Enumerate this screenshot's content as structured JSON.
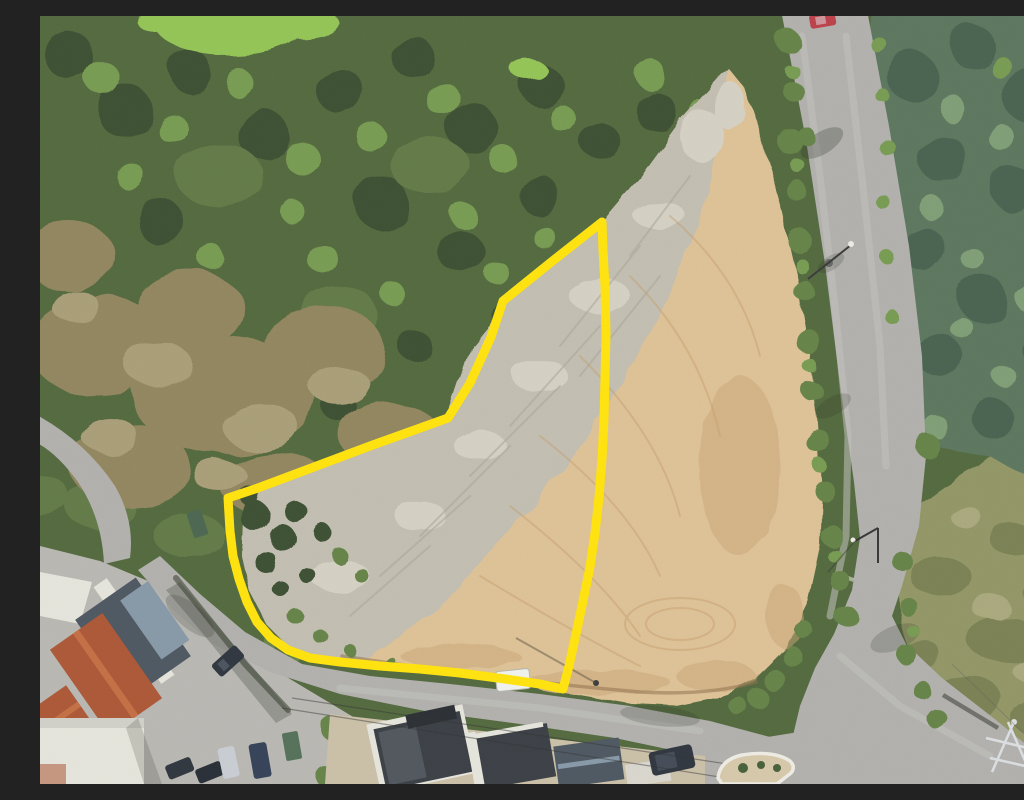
{
  "image": {
    "kind": "aerial-drone-photo",
    "subject": "Cleared building plot outlined in yellow between woodland and a rural road junction with houses at bottom left",
    "width": 1024,
    "height": 768
  },
  "boundary": {
    "color": "#ffe103",
    "stroke_width": 9,
    "points": "562,206 510,247 463,285 451,321 430,367 408,402 330,430 250,460 215,473 188,482 190,515 193,540 199,563 207,586 217,606 231,622 248,634 270,642 300,646 340,650 380,653 420,657 465,663 500,668 523,673 529,650 536,618 543,585 550,551 555,517 559,481 562,443 564,404 565,362 566,318 565,270 563,234"
  },
  "palette": {
    "forest_base": "#4c6336",
    "forest_light": "#72974b",
    "forest_dark": "#35482a",
    "forest_olive": "#5c7440",
    "scrub": "#8d8158",
    "scrub_light": "#a59a72",
    "grass_bright": "#8fc250",
    "conifer_base": "#567158",
    "conifer_dark": "#435c49",
    "conifer_light": "#7a9a70",
    "dirt_sand": "#dcbf92",
    "dirt_sand_dark": "#c7a372",
    "dirt_grey": "#bfbbae",
    "dirt_grey_light": "#d2cec1",
    "track_sand": "#c29a67",
    "track_grey": "#a7a295",
    "trench_brown": "#8a6e47",
    "road": "#aeada9",
    "road_light": "#c0bfba",
    "pavement": "#b6b4af",
    "field_olive": "#8e9261",
    "field_dark": "#747b4d",
    "field_light": "#a6a578",
    "verge_green": "#5f7e3f",
    "roof_red": "#a8512e",
    "roof_red_light": "#c2693d",
    "roof_slate": "#47515b",
    "roof_slate_light": "#8295a3",
    "roof_dark": "#33383e",
    "wall_white": "#e4e3da",
    "car_dark": "#272e37",
    "car_silver": "#c6cbd1",
    "car_navy": "#2c3a51",
    "car_white": "#eff1ed",
    "car_red": "#b93943",
    "dumpster_green": "#4e6b52",
    "island_sand": "#d4c6a6",
    "curb_white": "#eceae2",
    "pylon_grey": "#d9dde0",
    "shadow": "#1c2418",
    "wire_dark": "#2a2a2a"
  },
  "objects": [
    "forest-canopy",
    "dry-scrub-slope",
    "bright-grass-patch",
    "conifer-forest",
    "cleared-plot-gravel",
    "cleared-plot-sand",
    "plot-boundary-outline",
    "main-road",
    "side-street",
    "access-lane",
    "parking-area",
    "meadow-field",
    "traffic-island",
    "red-roof-house",
    "grey-roof-house",
    "construction-houses",
    "parked-cars",
    "white-van",
    "dark-van",
    "red-car",
    "street-lights",
    "power-pylon",
    "power-lines"
  ]
}
